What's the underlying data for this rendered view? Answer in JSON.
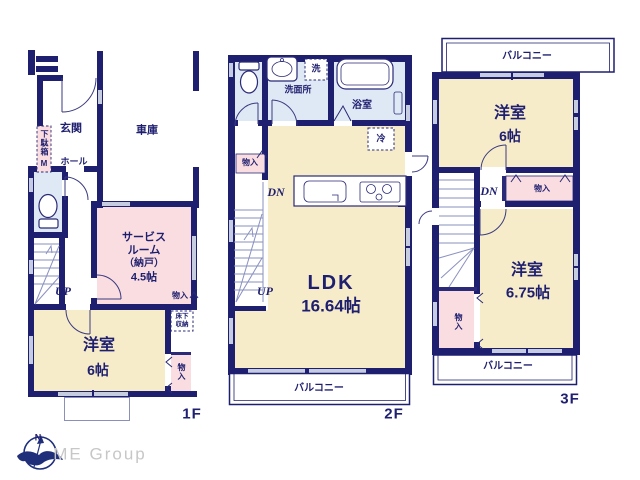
{
  "colors": {
    "wall": "#1f1f70",
    "room_cream": "#f7ecca",
    "room_pink": "#fadde0",
    "room_blue": "#dfe9f5",
    "logo_gray": "#c7c7c7"
  },
  "floor1": {
    "label": "1F",
    "entrance": "玄関",
    "garage": "車庫",
    "shoe_cabinet": "下駄箱",
    "shoe_cabinet_m": "M",
    "hall": "ホール",
    "service_room_line1": "サービス",
    "service_room_line2": "ルーム",
    "service_room_line3": "（納戸）",
    "service_room_line4": "4.5帖",
    "stairs_up": "UP",
    "closet_a": "物入",
    "underfloor_line1": "床下",
    "underfloor_line2": "収納",
    "western_room": "洋室",
    "western_room_size": "6帖",
    "closet_b": "物入"
  },
  "floor2": {
    "label": "2F",
    "washroom": "洗面所",
    "laundry": "洗",
    "bathroom": "浴室",
    "refrigerator": "冷",
    "closet": "物入",
    "stairs_down": "DN",
    "stairs_up": "UP",
    "ldk": "LDK",
    "ldk_size": "16.64帖",
    "balcony": "バルコニー"
  },
  "floor3": {
    "label": "3F",
    "balcony_top": "バルコニー",
    "western_room_a": "洋室",
    "western_room_a_size": "6帖",
    "stairs_down": "DN",
    "closet_a": "物入",
    "western_room_b": "洋室",
    "western_room_b_size": "6.75帖",
    "closet_b": "物入",
    "balcony_bottom": "バルコニー"
  },
  "footer": {
    "compass_north": "N",
    "company": "ME Group"
  }
}
